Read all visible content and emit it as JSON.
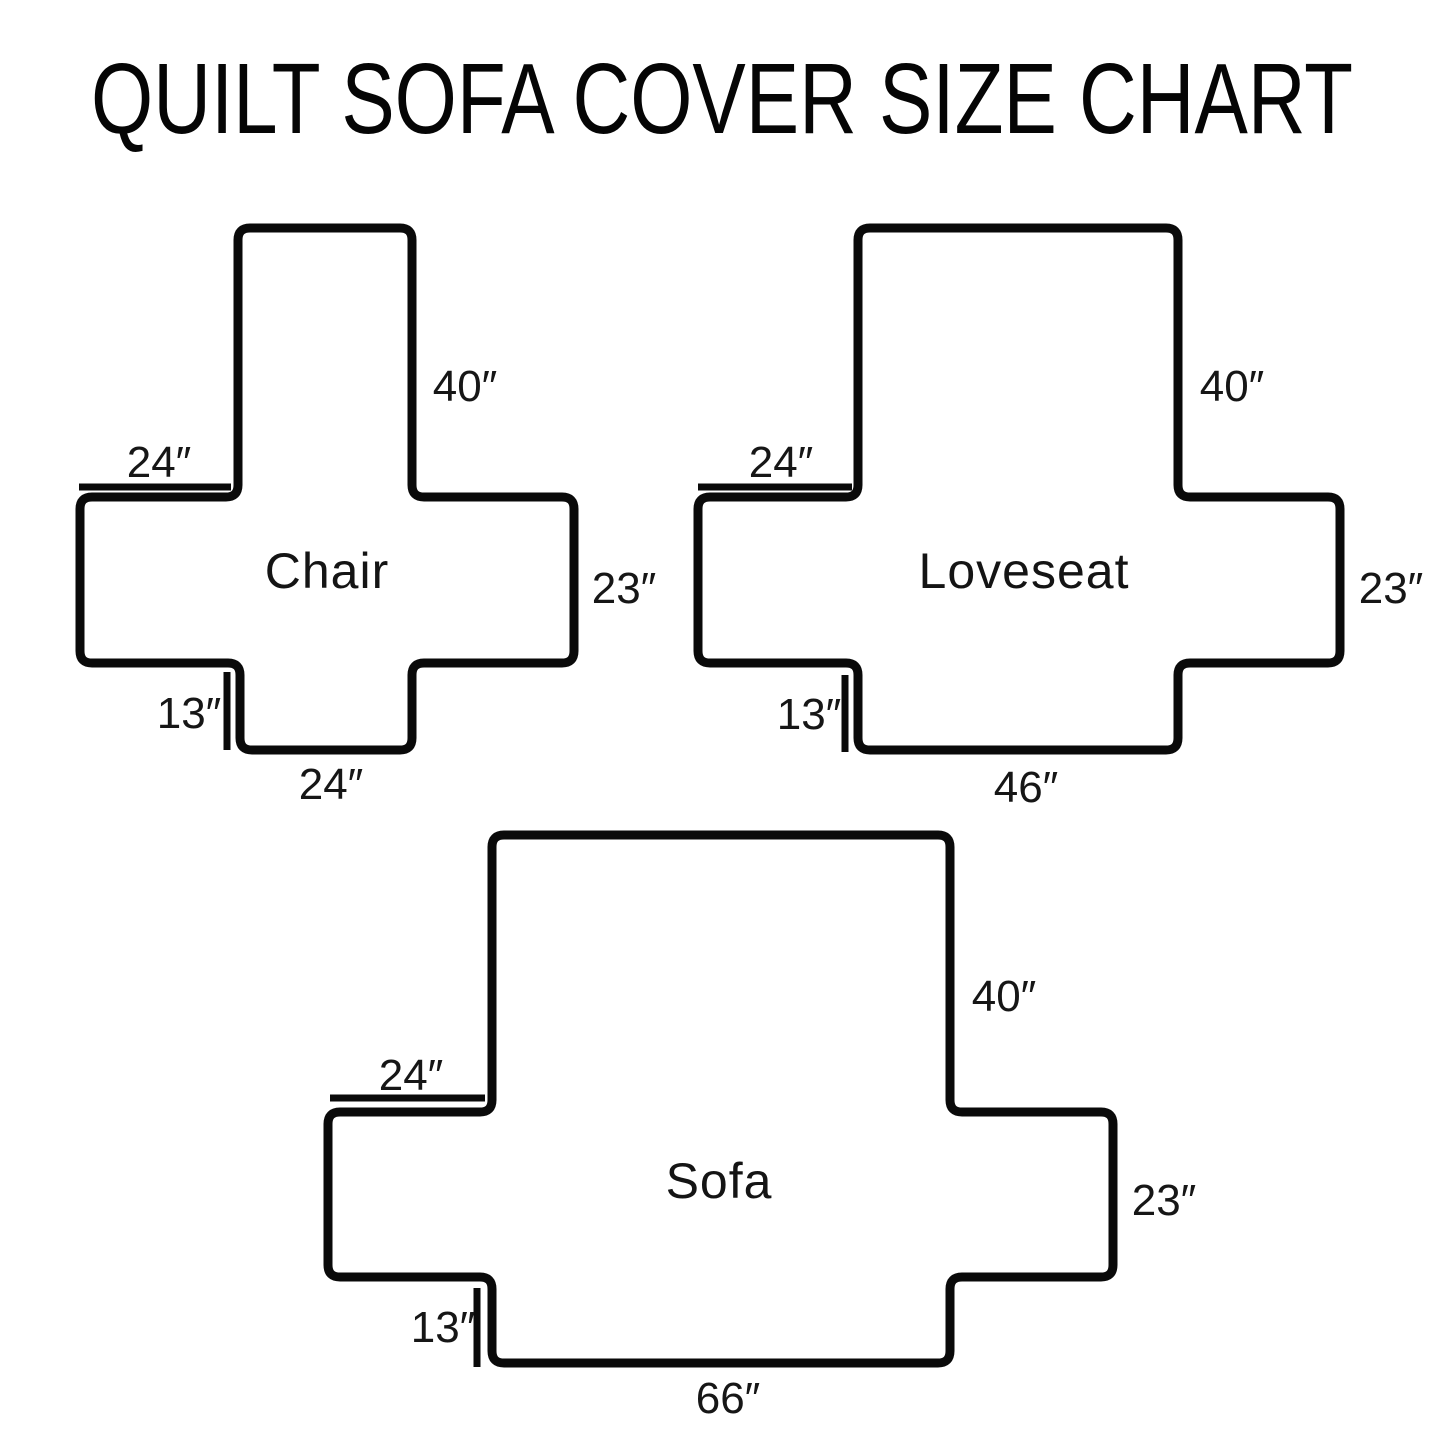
{
  "page": {
    "title": "QUILT SOFA COVER SIZE CHART",
    "background": "#ffffff",
    "line_color": "#0a0a0a"
  },
  "diagrams": [
    {
      "name": "Chair",
      "dims": {
        "back_height": "40″",
        "arm_top_width": "24″",
        "arm_side_height": "23″",
        "front_skirt_height": "13″",
        "seat_bottom_width": "24″"
      }
    },
    {
      "name": "Loveseat",
      "dims": {
        "back_height": "40″",
        "arm_top_width": "24″",
        "arm_side_height": "23″",
        "front_skirt_height": "13″",
        "seat_bottom_width": "46″"
      }
    },
    {
      "name": "Sofa",
      "dims": {
        "back_height": "40″",
        "arm_top_width": "24″",
        "arm_side_height": "23″",
        "front_skirt_height": "13″",
        "seat_bottom_width": "66″"
      }
    }
  ]
}
